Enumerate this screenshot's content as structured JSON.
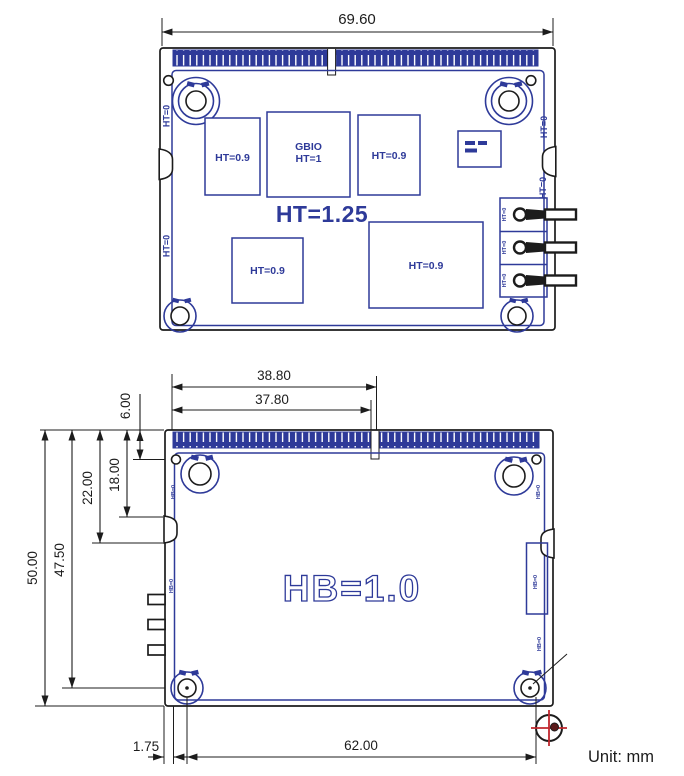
{
  "unit_label": "Unit: mm",
  "colors": {
    "line_black": "#1c1c1c",
    "drawing_blue": "#2e3a99",
    "datum_red": "#c1272d"
  },
  "top_view": {
    "width_dim": "69.60",
    "zone_height_label": "HT=1.25",
    "component_labels": {
      "box1": "HT=0.9",
      "box2_line1": "GBIO",
      "box2_line2": "HT=1",
      "box3": "HT=0.9",
      "box4": "HT=0.9",
      "box5": "HT=0.9"
    },
    "edge_height_label": "HT=0"
  },
  "bottom_view": {
    "zone_height_label": "HB=1.0",
    "edge_height_label": "HB=0",
    "dims": {
      "fingers_span_outer": "38.80",
      "fingers_span_inner": "37.80",
      "hole_center_from_top": "6.00",
      "left_notch_top": "18.00",
      "left_notch_bottom": "22.00",
      "board_height": "50.00",
      "bottom_holes_from_top": "47.50",
      "edge_to_fingers": "1.75",
      "bottom_hole_span": "62.00"
    }
  }
}
